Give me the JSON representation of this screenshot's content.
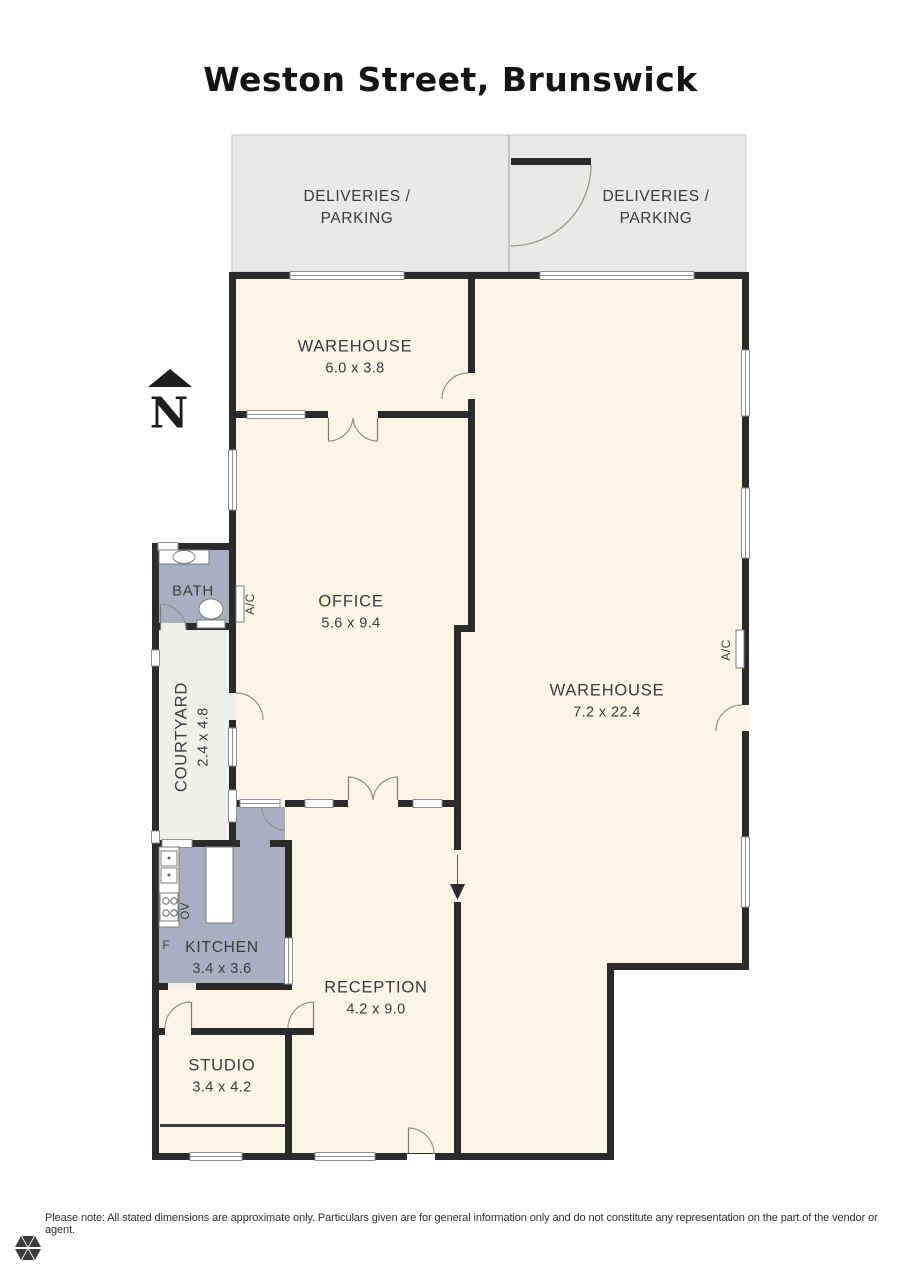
{
  "page": {
    "title": "Weston Street, Brunswick"
  },
  "compass": {
    "north_label": "N"
  },
  "outdoor_areas": [
    {
      "id": "deliveries-left",
      "line1": "DELIVERIES /",
      "line2": "PARKING"
    },
    {
      "id": "deliveries-right",
      "line1": "DELIVERIES /",
      "line2": "PARKING"
    }
  ],
  "rooms": [
    {
      "id": "warehouse-small",
      "name": "WAREHOUSE",
      "dims": "6.0 x 3.8"
    },
    {
      "id": "office",
      "name": "OFFICE",
      "dims": "5.6 x 9.4"
    },
    {
      "id": "warehouse-main",
      "name": "WAREHOUSE",
      "dims": "7.2 x 22.4"
    },
    {
      "id": "bath",
      "name": "BATH"
    },
    {
      "id": "courtyard",
      "name": "COURTYARD",
      "dims": "2.4 x 4.8"
    },
    {
      "id": "kitchen",
      "name": "KITCHEN",
      "dims": "3.4 x 3.6"
    },
    {
      "id": "reception",
      "name": "RECEPTION",
      "dims": "4.2 x 9.0"
    },
    {
      "id": "studio",
      "name": "STUDIO",
      "dims": "3.4 x 4.2"
    }
  ],
  "fixture_labels": {
    "ac": "A/C",
    "oven": "OV",
    "fridge": "F"
  },
  "footer": {
    "disclaimer": "Please note: All stated dimensions are approximate only. Particulars given are for general information only and do not constitute any representation on the part of the vendor or agent."
  },
  "colors": {
    "wall": "#2b2b2c",
    "interior": "#fdf4e6",
    "wet_area": "#a9afc1",
    "courtyard_fill": "#efefec",
    "outdoor": "#e9e9e7",
    "label_text": "#3b3b3d"
  }
}
